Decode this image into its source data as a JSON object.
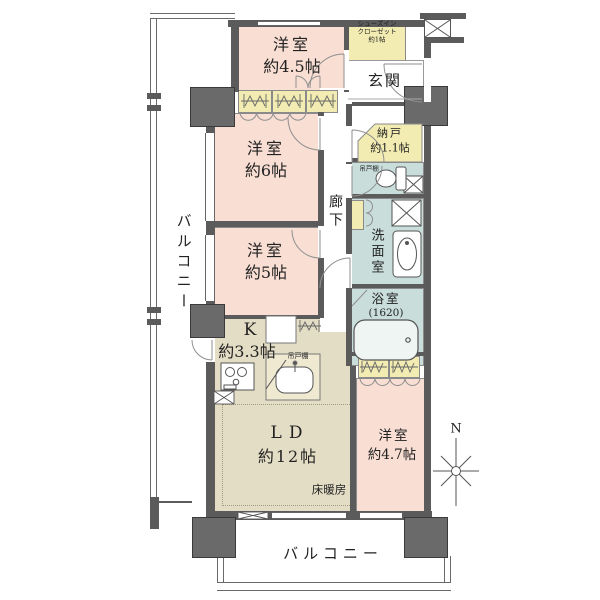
{
  "colors": {
    "wall": "#5b5b5b",
    "pillar": "#6a6a6a",
    "room_pink": "#f8ded3",
    "closet_yellow": "#f2ecb2",
    "wet_blue": "#c9dedb",
    "ld_beige": "#e4ddc5",
    "text": "#222222"
  },
  "labels": {
    "balcony_left": "バルコニー",
    "balcony_bottom": "バルコニー",
    "room_45_name": "洋室",
    "room_45_size": "約4.5帖",
    "sic_line1": "シューズイン",
    "sic_line2": "クローゼット",
    "sic_line3": "約1帖",
    "genkan": "玄関",
    "nando_name": "納戸",
    "nando_size": "約1.1帖",
    "hanging_cabinet_toilet": "吊戸棚",
    "room_6_name": "洋室",
    "room_6_size": "約6帖",
    "hallway": "廊下",
    "washroom": "洗面室",
    "bath_name": "浴室",
    "bath_size": "(1620)",
    "room_5_name": "洋室",
    "room_5_size": "約5帖",
    "kitchen_name": "K",
    "kitchen_size": "約3.3帖",
    "hanging_cabinet_kitchen": "吊戸棚",
    "ld_name": "LD",
    "ld_size": "約12帖",
    "floor_heating": "床暖房",
    "room_47_name": "洋室",
    "room_47_size": "約4.7帖",
    "compass_north": "N"
  }
}
